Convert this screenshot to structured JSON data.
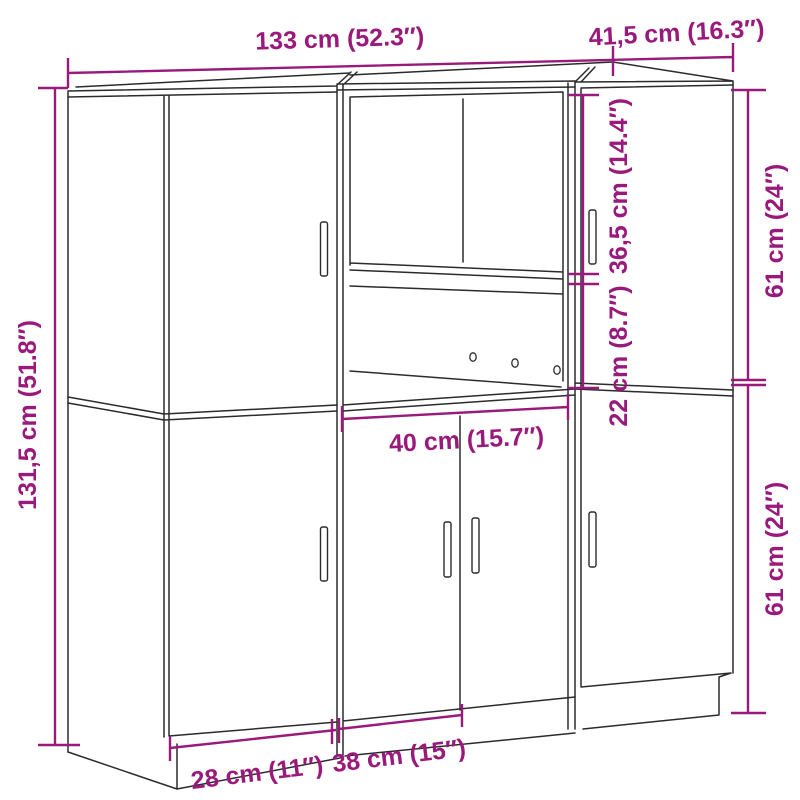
{
  "colors": {
    "dimension_annotation": "#9A1A7C",
    "line_art": "#2b2b2b",
    "background": "#ffffff"
  },
  "diagram": {
    "labels": {
      "total_width": "133 cm (52.3″)",
      "side_depth": "41,5 cm (16.3″)",
      "total_height": "131,5 cm (51.8″)",
      "upper_right_height": "61 cm (24″)",
      "lower_right_height": "61 cm (24″)",
      "upper_opening_height": "36,5 cm (14.4″)",
      "lower_opening_height": "22 cm (8.7″)",
      "open_compartment_width": "40 cm (15.7″)",
      "bottom_left_width": "28 cm (11″)",
      "bottom_middle_width": "38 cm (15″)"
    }
  }
}
